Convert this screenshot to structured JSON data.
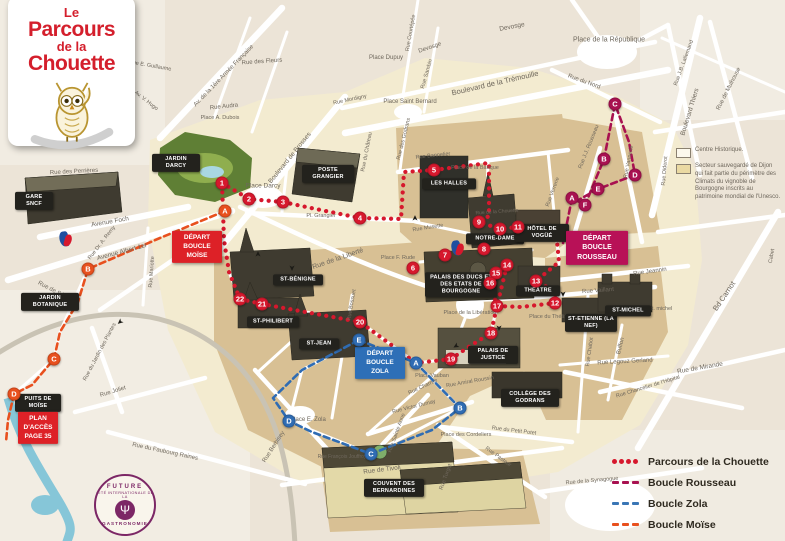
{
  "logo": {
    "line1": "Le",
    "line2": "Parcours",
    "line3": "de la",
    "line4": "Chouette"
  },
  "zones_legend": {
    "items": [
      {
        "label": "Centre Historique.",
        "swatch": "#fcf8ec"
      },
      {
        "label": "Secteur sauvegardé de Dijon qui fait partie du périmètre des Climats du vignoble de Bourgogne inscrits au patrimoine mondial de l'Unesco.",
        "swatch": "#ead9a2"
      }
    ]
  },
  "routes_legend": {
    "items": [
      {
        "label": "Parcours de la Chouette",
        "color": "#d6182d",
        "style": "dots"
      },
      {
        "label": "Boucle Rousseau",
        "color": "#a81150",
        "style": "dashes"
      },
      {
        "label": "Boucle Zola",
        "color": "#3a76b5",
        "style": "dashes"
      },
      {
        "label": "Boucle Moïse",
        "color": "#e8501e",
        "style": "dashes"
      }
    ]
  },
  "stamp": {
    "top": "FUTURE",
    "ring": "CITÉ INTERNATIONALE DE LA",
    "bottom": "GASTRONOMIE",
    "fork_glyph": "Ψ"
  },
  "map": {
    "route_colors": {
      "chouette": "#d6182d",
      "rousseau": "#a81150",
      "zola": "#2f6cb3",
      "moise": "#e8501e"
    },
    "arrow_glyph": "➤",
    "routes": [
      {
        "group": "chouette",
        "style": "dots",
        "width": 4.2,
        "points": [
          [
            222,
            183
          ],
          [
            249,
            199
          ],
          [
            283,
            202
          ],
          [
            311,
            208
          ],
          [
            360,
            218
          ],
          [
            401,
            219
          ],
          [
            404,
            172
          ],
          [
            434,
            170
          ],
          [
            489,
            163
          ],
          [
            489,
            216
          ],
          [
            479,
            222
          ],
          [
            500,
            229
          ],
          [
            518,
            227
          ],
          [
            556,
            231
          ],
          [
            559,
            262
          ],
          [
            536,
            281
          ],
          [
            556,
            292
          ],
          [
            555,
            303
          ],
          [
            521,
            307
          ],
          [
            497,
            306
          ],
          [
            490,
            283
          ],
          [
            496,
            273
          ],
          [
            507,
            265
          ],
          [
            497,
            306
          ],
          [
            491,
            333
          ],
          [
            470,
            346
          ],
          [
            451,
            359
          ],
          [
            416,
            363
          ],
          [
            360,
            322
          ],
          [
            300,
            311
          ],
          [
            262,
            304
          ],
          [
            240,
            299
          ],
          [
            229,
            272
          ],
          [
            224,
            240
          ],
          [
            222,
            183
          ]
        ]
      },
      {
        "group": "rousseau",
        "style": "dashes",
        "width": 2.6,
        "points": [
          [
            563,
            243
          ],
          [
            572,
            198
          ],
          [
            585,
            205
          ],
          [
            604,
            159
          ],
          [
            615,
            104
          ],
          [
            629,
            142
          ],
          [
            635,
            175
          ],
          [
            598,
            189
          ],
          [
            575,
            202
          ]
        ]
      },
      {
        "group": "zola",
        "style": "dashes",
        "width": 2.6,
        "points": [
          [
            359,
            340
          ],
          [
            416,
            363
          ],
          [
            460,
            408
          ],
          [
            432,
            430
          ],
          [
            371,
            454
          ],
          [
            312,
            432
          ],
          [
            289,
            421
          ],
          [
            273,
            398
          ],
          [
            302,
            370
          ],
          [
            359,
            340
          ]
        ]
      },
      {
        "group": "moise",
        "style": "dashes",
        "width": 2.6,
        "points": [
          [
            225,
            211
          ],
          [
            160,
            238
          ],
          [
            88,
            269
          ],
          [
            78,
            302
          ],
          [
            60,
            332
          ],
          [
            54,
            359
          ],
          [
            32,
            385
          ],
          [
            14,
            394
          ],
          [
            8,
            420
          ],
          [
            6,
            442
          ]
        ]
      }
    ],
    "waypoints": [
      [
        "chouette",
        "1",
        222,
        183
      ],
      [
        "chouette",
        "2",
        249,
        199
      ],
      [
        "chouette",
        "3",
        283,
        202
      ],
      [
        "chouette",
        "4",
        360,
        218
      ],
      [
        "chouette",
        "5",
        434,
        170
      ],
      [
        "chouette",
        "6",
        413,
        268
      ],
      [
        "chouette",
        "7",
        445,
        255
      ],
      [
        "chouette",
        "8",
        484,
        249
      ],
      [
        "chouette",
        "9",
        479,
        222
      ],
      [
        "chouette",
        "10",
        500,
        229
      ],
      [
        "chouette",
        "11",
        518,
        227
      ],
      [
        "chouette",
        "12",
        555,
        303
      ],
      [
        "chouette",
        "13",
        536,
        281
      ],
      [
        "chouette",
        "14",
        507,
        265
      ],
      [
        "chouette",
        "15",
        496,
        273
      ],
      [
        "chouette",
        "16",
        490,
        283
      ],
      [
        "chouette",
        "17",
        497,
        306
      ],
      [
        "chouette",
        "18",
        491,
        333
      ],
      [
        "chouette",
        "19",
        451,
        359
      ],
      [
        "chouette",
        "20",
        360,
        322
      ],
      [
        "chouette",
        "21",
        262,
        304
      ],
      [
        "chouette",
        "22",
        240,
        299
      ],
      [
        "rousseau",
        "A",
        572,
        198
      ],
      [
        "rousseau",
        "B",
        604,
        159
      ],
      [
        "rousseau",
        "C",
        615,
        104
      ],
      [
        "rousseau",
        "D",
        635,
        175
      ],
      [
        "rousseau",
        "E",
        598,
        189
      ],
      [
        "rousseau",
        "F",
        585,
        205
      ],
      [
        "zola",
        "A",
        416,
        363
      ],
      [
        "zola",
        "B",
        460,
        408
      ],
      [
        "zola",
        "C",
        371,
        454
      ],
      [
        "zola",
        "D",
        289,
        421
      ],
      [
        "zola",
        "E",
        359,
        340
      ],
      [
        "moise",
        "A",
        225,
        211
      ],
      [
        "moise",
        "B",
        88,
        269
      ],
      [
        "moise",
        "C",
        54,
        359
      ],
      [
        "moise",
        "D",
        14,
        394
      ]
    ],
    "landmarks": [
      [
        "JARDIN DARCY",
        176,
        163,
        42
      ],
      [
        "GARE SNCF",
        34,
        201,
        32
      ],
      [
        "JARDIN BOTANIQUE",
        50,
        302,
        52
      ],
      [
        "PUITS DE MOÏSE",
        38,
        403,
        40
      ],
      [
        "POSTE GRANGIER",
        328,
        174,
        46
      ],
      [
        "LES HALLES",
        449,
        184,
        48
      ],
      [
        "NOTRE-DAME",
        495,
        239,
        52
      ],
      [
        "HÔTEL DE VOGÜÉ",
        542,
        233,
        48
      ],
      [
        "PALAIS DES DUCS ET DES ETATS DE BOURGOGNE",
        461,
        285,
        66
      ],
      [
        "THÉÂTRE",
        538,
        291,
        38
      ],
      [
        "ST-ETIENNE (LA NEF)",
        591,
        323,
        46
      ],
      [
        "ST-MICHEL",
        628,
        311,
        40
      ],
      [
        "ST-BÉNIGNE",
        298,
        280,
        44
      ],
      [
        "ST-PHILIBERT",
        273,
        322,
        46
      ],
      [
        "ST-JEAN",
        319,
        344,
        34
      ],
      [
        "PALAIS DE JUSTICE",
        493,
        355,
        44
      ],
      [
        "COLLÈGE DES GODRANS",
        530,
        398,
        52
      ],
      [
        "COUVENT DES BERNARDINES",
        394,
        488,
        54
      ]
    ],
    "boxes": [
      {
        "label": "DÉPART BOUCLE MOÏSE",
        "x": 197,
        "y": 247,
        "w": 44,
        "color": "#dd2127"
      },
      {
        "label": "DÉPART BOUCLE ROUSSEAU",
        "x": 597,
        "y": 248,
        "w": 56,
        "fs": 7,
        "color": "#b81157"
      },
      {
        "label": "DÉPART BOUCLE ZOLA",
        "x": 380,
        "y": 363,
        "w": 44,
        "color": "#2e6fb7"
      },
      {
        "label": "Plan d'accès page 35",
        "x": 38,
        "y": 428,
        "w": 34,
        "color": "#dd2127"
      }
    ],
    "street_labels": [
      [
        "Av. de la 1ère Armée Française",
        224,
        76,
        -46,
        6
      ],
      [
        "Boulevard de Brosses",
        290,
        158,
        -51,
        6.5
      ],
      [
        "Boulevard de la Trémouille",
        495,
        83,
        -13,
        7.5
      ],
      [
        "Devosge",
        512,
        27,
        -11,
        6.5
      ],
      [
        "Devosge",
        430,
        48,
        -19,
        6
      ],
      [
        "Rue Courtépée",
        411,
        33,
        -80,
        5.5
      ],
      [
        "Rue Sambin",
        427,
        74,
        -74,
        5.5
      ],
      [
        "Rue des Fleurs",
        262,
        62,
        -4,
        6
      ],
      [
        "Rue Audra",
        224,
        107,
        -6,
        6
      ],
      [
        "Place A. Dubois",
        220,
        118,
        0,
        5.5
      ],
      [
        "Rue Mordigny",
        350,
        100,
        -12,
        5.5
      ],
      [
        "Place Dupuy",
        386,
        58,
        0,
        6
      ],
      [
        "Place Saint Bernard",
        410,
        102,
        0,
        6
      ],
      [
        "Rue E. Guillaume",
        150,
        66,
        10,
        5.5
      ],
      [
        "Av. V. Hugo",
        146,
        101,
        38,
        5.5
      ],
      [
        "Rue des Perrières",
        74,
        172,
        -3,
        6
      ],
      [
        "Avenue Foch",
        110,
        222,
        -10,
        6.5
      ],
      [
        "Rue Dr. A. Remy",
        102,
        243,
        -52,
        5.5
      ],
      [
        "Avenue Albert 1er",
        122,
        252,
        -15,
        6.5
      ],
      [
        "Rue de Sévigné",
        57,
        293,
        28,
        6
      ],
      [
        "Rue Mariotte",
        152,
        272,
        -86,
        5.5
      ],
      [
        "Place Darcy",
        263,
        186,
        0,
        6.5
      ],
      [
        "Pl. Grangier",
        321,
        216,
        0,
        5.5
      ],
      [
        "Rue de la Liberté",
        338,
        259,
        -19,
        7
      ],
      [
        "Rue du Château",
        367,
        152,
        -79,
        5.5
      ],
      [
        "Rue des Godrans",
        404,
        139,
        -76,
        5.5
      ],
      [
        "Rue Bannelier",
        433,
        156,
        -6,
        5.5
      ],
      [
        "Place de la Banque",
        475,
        168,
        0,
        5.5
      ],
      [
        "Rue Musette",
        428,
        228,
        -9,
        5.5
      ],
      [
        "Rue de la Chouette",
        497,
        212,
        -4,
        5
      ],
      [
        "Rue Verrerie",
        553,
        192,
        -70,
        5.5
      ],
      [
        "Place F. Rude",
        398,
        258,
        0,
        5.5
      ],
      [
        "Place de la Libération",
        470,
        313,
        0,
        5.5
      ],
      [
        "Place du Théâtre",
        550,
        317,
        0,
        5.5
      ],
      [
        "Rue Vaillant",
        598,
        291,
        -4,
        6
      ],
      [
        "Rue Jeannin",
        650,
        272,
        -8,
        6
      ],
      [
        "pl. st. michel",
        657,
        309,
        0,
        5.5
      ],
      [
        "Rue du Nord",
        584,
        82,
        20,
        6
      ],
      [
        "Place de la République",
        609,
        40,
        0,
        7
      ],
      [
        "Boulevard Thiers",
        690,
        112,
        -73,
        6.5
      ],
      [
        "Rue de Mulhouse",
        729,
        89,
        -63,
        6
      ],
      [
        "Rue J.B. Lallemand",
        684,
        63,
        -70,
        5.5
      ],
      [
        "Rue J.J. Rousseau",
        589,
        147,
        -68,
        5.5
      ],
      [
        "Rue Vannerie",
        629,
        162,
        -79,
        5.5
      ],
      [
        "Rue Diderot",
        665,
        171,
        -85,
        5.5
      ],
      [
        "Cabet",
        772,
        256,
        -80,
        5.5
      ],
      [
        "Bd Carnot",
        724,
        296,
        -56,
        7.5
      ],
      [
        "Rue de Mirande",
        700,
        368,
        -10,
        6.5
      ],
      [
        "Rue Chancelier de l'Hôpital",
        648,
        387,
        -17,
        5.5
      ],
      [
        "Buffon",
        621,
        346,
        -76,
        6
      ],
      [
        "Rue Chabot",
        590,
        352,
        -82,
        5.5
      ],
      [
        "Rue Legouz Gerland",
        625,
        362,
        -3,
        6
      ],
      [
        "Rue du Petit Potet",
        514,
        431,
        7,
        5.5
      ],
      [
        "Rue Pasteur",
        498,
        457,
        36,
        5.5
      ],
      [
        "Rue Turgot",
        446,
        477,
        -70,
        5.5
      ],
      [
        "Rue de la Synagogue",
        592,
        481,
        -5,
        5.5
      ],
      [
        "Place des Cordeliers",
        466,
        435,
        0,
        5.5
      ],
      [
        "Rue Victor Dumay",
        414,
        407,
        -14,
        5.5
      ],
      [
        "Rue Sainte Anne",
        397,
        433,
        -70,
        5.5
      ],
      [
        "Rue Charrue",
        423,
        387,
        -25,
        5.5
      ],
      [
        "Rue Amiral Roussin",
        470,
        382,
        -10,
        5.5
      ],
      [
        "Place Vauban",
        432,
        376,
        0,
        5.5
      ],
      [
        "Place E. Zola",
        308,
        420,
        0,
        6
      ],
      [
        "Rue Berbisey",
        274,
        447,
        -57,
        6
      ],
      [
        "Rue Bossuet",
        352,
        305,
        -80,
        5.5
      ],
      [
        "Rue de Tivoli",
        382,
        470,
        -7,
        6.5
      ],
      [
        "Rue du Faubourg Raines",
        165,
        452,
        12,
        6
      ],
      [
        "Rue Joliet",
        113,
        392,
        -17,
        6
      ],
      [
        "Rue du Jardin des Plantes",
        100,
        352,
        -62,
        5.5
      ],
      [
        "Rue François Jouffroy",
        342,
        457,
        0,
        5
      ]
    ],
    "arrows": [
      [
        415,
        218,
        -90
      ],
      [
        499,
        328,
        90
      ],
      [
        563,
        294,
        90
      ],
      [
        258,
        254,
        -90
      ],
      [
        292,
        268,
        90
      ],
      [
        456,
        346,
        150
      ],
      [
        120,
        322,
        140
      ]
    ],
    "info_icons": [
      [
        66,
        240
      ],
      [
        458,
        249
      ]
    ]
  }
}
